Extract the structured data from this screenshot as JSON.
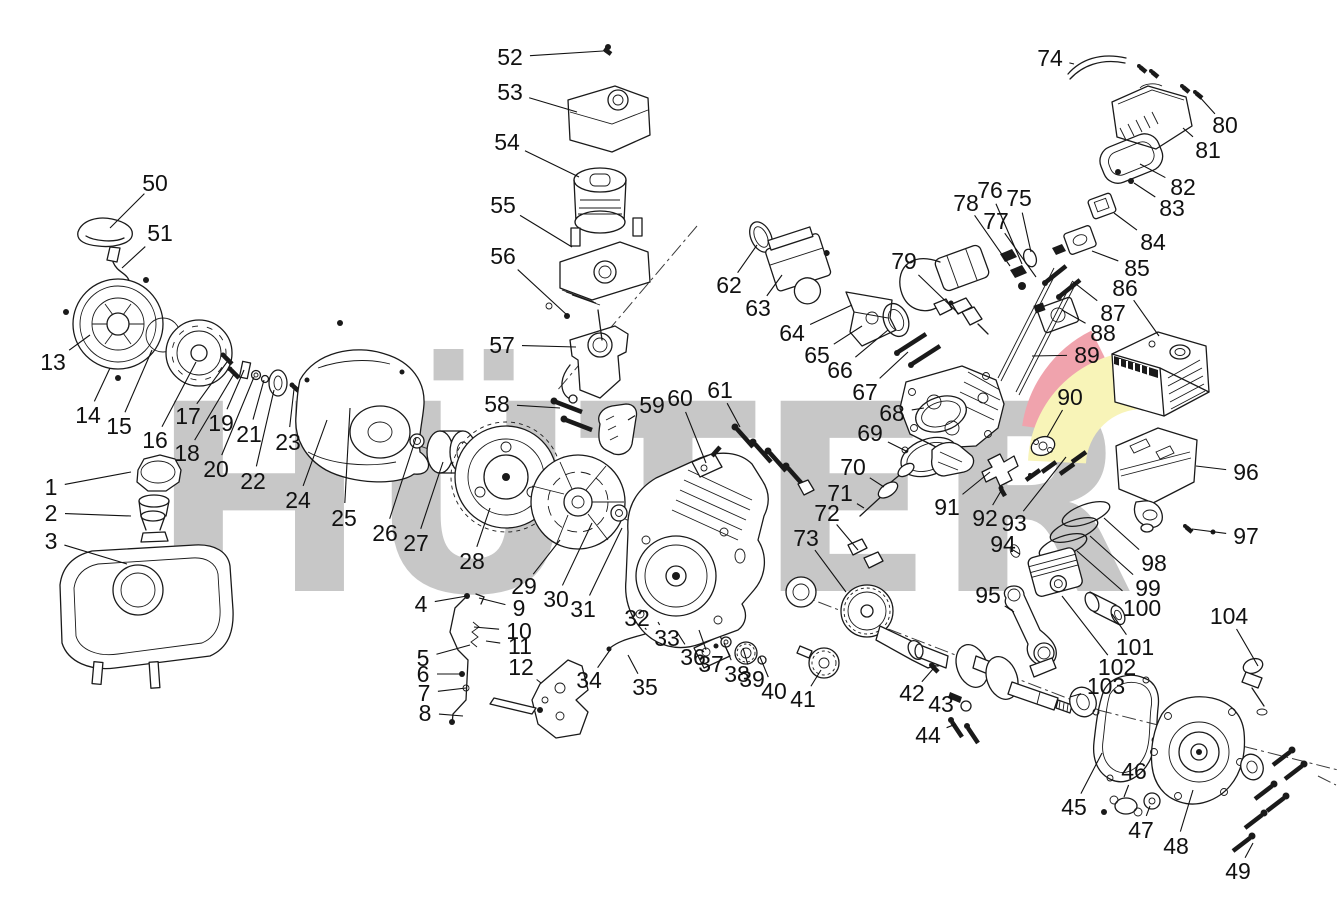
{
  "watermark": {
    "text": "HÜTER",
    "letter_color": "#c7c7c7",
    "swoosh_red": "#f0a3ad",
    "swoosh_yellow": "#f8f4b8"
  },
  "callouts": [
    {
      "n": "1",
      "x": 51,
      "y": 487,
      "tx": 131,
      "ty": 472
    },
    {
      "n": "2",
      "x": 51,
      "y": 513,
      "tx": 131,
      "ty": 516
    },
    {
      "n": "3",
      "x": 51,
      "y": 541,
      "tx": 127,
      "ty": 564
    },
    {
      "n": "4",
      "x": 421,
      "y": 604,
      "tx": 467,
      "ty": 596
    },
    {
      "n": "5",
      "x": 423,
      "y": 658,
      "tx": 470,
      "ty": 645
    },
    {
      "n": "6",
      "x": 423,
      "y": 674,
      "tx": 462,
      "ty": 674
    },
    {
      "n": "7",
      "x": 424,
      "y": 693,
      "tx": 466,
      "ty": 688
    },
    {
      "n": "8",
      "x": 425,
      "y": 713,
      "tx": 463,
      "ty": 716
    },
    {
      "n": "9",
      "x": 519,
      "y": 608,
      "tx": 479,
      "ty": 598
    },
    {
      "n": "10",
      "x": 519,
      "y": 631,
      "tx": 474,
      "ty": 627
    },
    {
      "n": "11",
      "x": 520,
      "y": 646,
      "tx": 486,
      "ty": 641
    },
    {
      "n": "12",
      "x": 521,
      "y": 667,
      "tx": 541,
      "ty": 683
    },
    {
      "n": "13",
      "x": 53,
      "y": 362,
      "tx": 90,
      "ty": 335
    },
    {
      "n": "14",
      "x": 88,
      "y": 415,
      "tx": 110,
      "ty": 368
    },
    {
      "n": "15",
      "x": 119,
      "y": 426,
      "tx": 152,
      "ty": 350
    },
    {
      "n": "16",
      "x": 155,
      "y": 440,
      "tx": 196,
      "ty": 362
    },
    {
      "n": "17",
      "x": 188,
      "y": 416,
      "tx": 227,
      "ty": 362
    },
    {
      "n": "18",
      "x": 187,
      "y": 453,
      "tx": 234,
      "ty": 374
    },
    {
      "n": "19",
      "x": 221,
      "y": 423,
      "tx": 244,
      "ty": 370
    },
    {
      "n": "20",
      "x": 216,
      "y": 469,
      "tx": 254,
      "ty": 377
    },
    {
      "n": "21",
      "x": 249,
      "y": 434,
      "tx": 264,
      "ty": 380
    },
    {
      "n": "22",
      "x": 253,
      "y": 481,
      "tx": 274,
      "ty": 390
    },
    {
      "n": "23",
      "x": 288,
      "y": 442,
      "tx": 294,
      "ty": 389
    },
    {
      "n": "24",
      "x": 298,
      "y": 500,
      "tx": 327,
      "ty": 420
    },
    {
      "n": "25",
      "x": 344,
      "y": 518,
      "tx": 350,
      "ty": 408
    },
    {
      "n": "26",
      "x": 385,
      "y": 533,
      "tx": 416,
      "ty": 438
    },
    {
      "n": "27",
      "x": 416,
      "y": 543,
      "tx": 443,
      "ty": 462
    },
    {
      "n": "28",
      "x": 472,
      "y": 561,
      "tx": 490,
      "ty": 508
    },
    {
      "n": "29",
      "x": 524,
      "y": 586,
      "tx": 560,
      "ty": 540
    },
    {
      "n": "30",
      "x": 556,
      "y": 599,
      "tx": 592,
      "ty": 523
    },
    {
      "n": "31",
      "x": 583,
      "y": 609,
      "tx": 622,
      "ty": 528
    },
    {
      "n": "32",
      "x": 637,
      "y": 618,
      "tx": 645,
      "ty": 628
    },
    {
      "n": "33",
      "x": 667,
      "y": 638,
      "tx": 658,
      "ty": 622
    },
    {
      "n": "34",
      "x": 589,
      "y": 680,
      "tx": 610,
      "ty": 650
    },
    {
      "n": "35",
      "x": 645,
      "y": 687,
      "tx": 628,
      "ty": 655
    },
    {
      "n": "36",
      "x": 693,
      "y": 657,
      "tx": 677,
      "ty": 632
    },
    {
      "n": "37",
      "x": 711,
      "y": 664,
      "tx": 699,
      "ty": 630
    },
    {
      "n": "38",
      "x": 737,
      "y": 674,
      "tx": 724,
      "ty": 643
    },
    {
      "n": "39",
      "x": 752,
      "y": 679,
      "tx": 743,
      "ty": 648
    },
    {
      "n": "40",
      "x": 774,
      "y": 691,
      "tx": 760,
      "ty": 657
    },
    {
      "n": "41",
      "x": 803,
      "y": 699,
      "tx": 821,
      "ty": 670
    },
    {
      "n": "42",
      "x": 912,
      "y": 693,
      "tx": 933,
      "ty": 669
    },
    {
      "n": "43",
      "x": 941,
      "y": 704,
      "tx": 959,
      "ty": 699
    },
    {
      "n": "44",
      "x": 928,
      "y": 735,
      "tx": 956,
      "ty": 724
    },
    {
      "n": "45",
      "x": 1074,
      "y": 807,
      "tx": 1102,
      "ty": 753
    },
    {
      "n": "46",
      "x": 1134,
      "y": 771,
      "tx": 1124,
      "ty": 797
    },
    {
      "n": "47",
      "x": 1141,
      "y": 830,
      "tx": 1150,
      "ty": 806
    },
    {
      "n": "48",
      "x": 1176,
      "y": 846,
      "tx": 1193,
      "ty": 790
    },
    {
      "n": "49",
      "x": 1238,
      "y": 871,
      "tx": 1253,
      "ty": 843
    },
    {
      "n": "50",
      "x": 155,
      "y": 183,
      "tx": 110,
      "ty": 228
    },
    {
      "n": "51",
      "x": 160,
      "y": 233,
      "tx": 122,
      "ty": 268
    },
    {
      "n": "52",
      "x": 510,
      "y": 57,
      "tx": 603,
      "ty": 51
    },
    {
      "n": "53",
      "x": 510,
      "y": 92,
      "tx": 577,
      "ty": 112
    },
    {
      "n": "54",
      "x": 507,
      "y": 142,
      "tx": 579,
      "ty": 177
    },
    {
      "n": "55",
      "x": 503,
      "y": 205,
      "tx": 572,
      "ty": 247
    },
    {
      "n": "56",
      "x": 503,
      "y": 256,
      "tx": 567,
      "ty": 315
    },
    {
      "n": "57",
      "x": 502,
      "y": 345,
      "tx": 576,
      "ty": 347
    },
    {
      "n": "58",
      "x": 497,
      "y": 404,
      "tx": 560,
      "ty": 408
    },
    {
      "n": "59",
      "x": 652,
      "y": 405,
      "tx": 628,
      "ty": 420
    },
    {
      "n": "60",
      "x": 680,
      "y": 398,
      "tx": 706,
      "ty": 463
    },
    {
      "n": "61",
      "x": 720,
      "y": 390,
      "tx": 740,
      "ty": 427
    },
    {
      "n": "62",
      "x": 729,
      "y": 285,
      "tx": 757,
      "ty": 245
    },
    {
      "n": "63",
      "x": 758,
      "y": 308,
      "tx": 782,
      "ty": 275
    },
    {
      "n": "64",
      "x": 792,
      "y": 333,
      "tx": 852,
      "ty": 305
    },
    {
      "n": "65",
      "x": 817,
      "y": 355,
      "tx": 862,
      "ty": 326
    },
    {
      "n": "66",
      "x": 840,
      "y": 370,
      "tx": 888,
      "ty": 330
    },
    {
      "n": "67",
      "x": 865,
      "y": 392,
      "tx": 908,
      "ty": 352
    },
    {
      "n": "68",
      "x": 892,
      "y": 413,
      "tx": 924,
      "ty": 408
    },
    {
      "n": "69",
      "x": 870,
      "y": 433,
      "tx": 908,
      "ty": 452
    },
    {
      "n": "70",
      "x": 853,
      "y": 467,
      "tx": 884,
      "ty": 487
    },
    {
      "n": "71",
      "x": 840,
      "y": 493,
      "tx": 864,
      "ty": 508
    },
    {
      "n": "72",
      "x": 827,
      "y": 513,
      "tx": 858,
      "ty": 550
    },
    {
      "n": "73",
      "x": 806,
      "y": 538,
      "tx": 846,
      "ty": 592
    },
    {
      "n": "74",
      "x": 1050,
      "y": 58,
      "tx": 1074,
      "ty": 64
    },
    {
      "n": "75",
      "x": 1019,
      "y": 198,
      "tx": 1031,
      "ty": 252
    },
    {
      "n": "76",
      "x": 990,
      "y": 190,
      "tx": 1022,
      "ty": 264
    },
    {
      "n": "77",
      "x": 996,
      "y": 221,
      "tx": 1036,
      "ty": 277
    },
    {
      "n": "78",
      "x": 966,
      "y": 203,
      "tx": 1010,
      "ty": 266
    },
    {
      "n": "79",
      "x": 904,
      "y": 261,
      "tx": 959,
      "ty": 314
    },
    {
      "n": "80",
      "x": 1225,
      "y": 125,
      "tx": 1197,
      "ty": 94
    },
    {
      "n": "81",
      "x": 1208,
      "y": 150,
      "tx": 1183,
      "ty": 128
    },
    {
      "n": "82",
      "x": 1183,
      "y": 187,
      "tx": 1140,
      "ty": 164
    },
    {
      "n": "83",
      "x": 1172,
      "y": 208,
      "tx": 1134,
      "ty": 183
    },
    {
      "n": "84",
      "x": 1153,
      "y": 242,
      "tx": 1114,
      "ty": 213
    },
    {
      "n": "85",
      "x": 1137,
      "y": 268,
      "tx": 1092,
      "ty": 251
    },
    {
      "n": "86",
      "x": 1125,
      "y": 288,
      "tx": 1159,
      "ty": 336
    },
    {
      "n": "87",
      "x": 1113,
      "y": 313,
      "tx": 1072,
      "ty": 281
    },
    {
      "n": "88",
      "x": 1103,
      "y": 333,
      "tx": 1062,
      "ty": 310
    },
    {
      "n": "89",
      "x": 1087,
      "y": 355,
      "tx": 1032,
      "ty": 356
    },
    {
      "n": "90",
      "x": 1070,
      "y": 397,
      "tx": 1047,
      "ty": 437
    },
    {
      "n": "91",
      "x": 947,
      "y": 507,
      "tx": 990,
      "ty": 472
    },
    {
      "n": "92",
      "x": 985,
      "y": 518,
      "tx": 1001,
      "ty": 491
    },
    {
      "n": "93",
      "x": 1014,
      "y": 523,
      "tx": 1066,
      "ty": 457
    },
    {
      "n": "94",
      "x": 1003,
      "y": 544,
      "tx": 1013,
      "ty": 550
    },
    {
      "n": "95",
      "x": 988,
      "y": 595,
      "tx": 1014,
      "ty": 612
    },
    {
      "n": "96",
      "x": 1246,
      "y": 472,
      "tx": 1196,
      "ty": 466
    },
    {
      "n": "97",
      "x": 1246,
      "y": 536,
      "tx": 1192,
      "ty": 529
    },
    {
      "n": "98",
      "x": 1154,
      "y": 563,
      "tx": 1104,
      "ty": 518
    },
    {
      "n": "99",
      "x": 1148,
      "y": 588,
      "tx": 1090,
      "ty": 536
    },
    {
      "n": "100",
      "x": 1142,
      "y": 608,
      "tx": 1077,
      "ty": 551
    },
    {
      "n": "101",
      "x": 1135,
      "y": 647,
      "tx": 1112,
      "ty": 614
    },
    {
      "n": "102",
      "x": 1117,
      "y": 667,
      "tx": 1062,
      "ty": 596
    },
    {
      "n": "103",
      "x": 1106,
      "y": 686,
      "tx": 1070,
      "ty": 697
    },
    {
      "n": "104",
      "x": 1229,
      "y": 616,
      "tx": 1258,
      "ty": 666
    }
  ]
}
